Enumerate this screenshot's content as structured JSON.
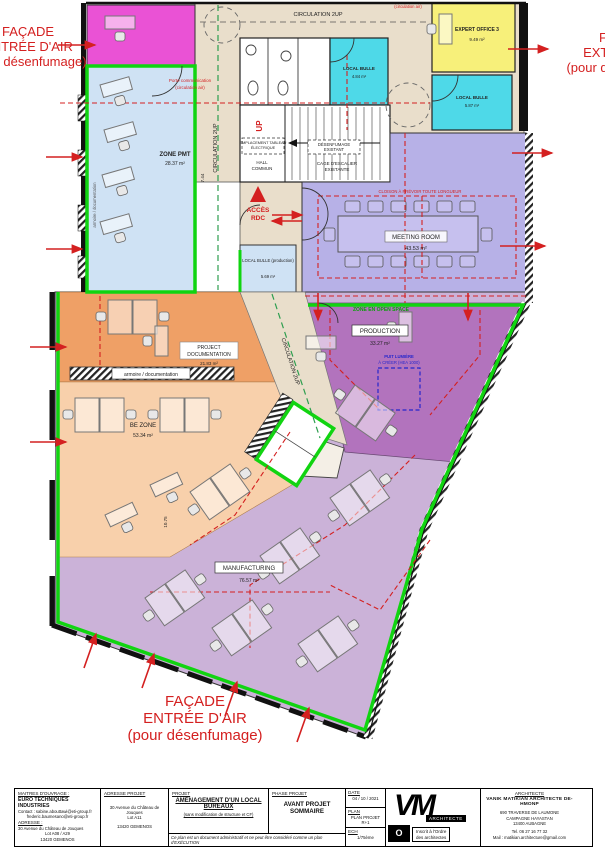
{
  "annotations": {
    "facade_tl_1": "FAÇADE",
    "facade_tl_2": "ENTRÉE D'AIR",
    "facade_tl_3": "(pour désenfumage)",
    "facade_tr_1": "FAÇADE",
    "facade_tr_2": "EXTRACTION",
    "facade_tr_3": "(pour désenfumage)",
    "facade_b_1": "FAÇADE",
    "facade_b_2": "ENTRÉE D'AIR",
    "facade_b_3": "(pour désenfumage)",
    "circulation_air": "(circulation air)",
    "porte_comm_1": "Porte communication",
    "porte_comm_2": "(circulation air)",
    "cloison": "CLOISON À PRÉVOIR TOUTE LONGUEUR",
    "zone_open_space": "ZONE EN OPEN SPACE",
    "puit_1": "PUIT LUMIÈRE",
    "puit_2": "À CRÉER (HEA 1000)",
    "acces_rdc_1": "ACCÈS",
    "acces_rdc_2": "RDC",
    "up": "UP"
  },
  "rooms": {
    "zone_pmt": {
      "name": "ZONE PMT",
      "area": "28.37 m²"
    },
    "expert_office": {
      "name": "EXPERT OFFICE 3",
      "area": "9.49 m²"
    },
    "local_bulle_1": {
      "name": "LOCAL BULLE",
      "area": "4.84 m²"
    },
    "local_bulle_2": {
      "name": "LOCAL BULLE",
      "area": "5.87 m²"
    },
    "local_bulle_prod": {
      "name": "LOCAL BULLE (production)",
      "area": "5.69 m²"
    },
    "meeting": {
      "name": "MEETING ROOM",
      "area": "43.53 m²"
    },
    "project_doc": {
      "name": "PROJECT",
      "name2": "DOCUMENTATION",
      "area": "21.83 m²"
    },
    "be_zone": {
      "name": "BE ZONE",
      "area": "53.34 m²"
    },
    "production": {
      "name": "PRODUCTION",
      "area": "33.27 m²"
    },
    "manufacturing": {
      "name": "MANUFACTURING",
      "area": "76.57 m²"
    },
    "hall_1": "HALL",
    "hall_2": "COMMUN",
    "cage_1": "CAGE D'ESCALIER",
    "cage_2": "EXISTANTE",
    "desenf_1": "DÉSENFUMAGE",
    "desenf_2": "EXISTANT",
    "tableau_1": "EMPLACEMENT TABLEAU",
    "tableau_2": "ÉLECTRIQUE"
  },
  "labels": {
    "circ_top": "CIRCULATION 2UP",
    "circ_vert": "CIRCULATION 2UP",
    "circ_diag": "CIRCULATION 2UP",
    "armoire_doc": "armoire / documentation",
    "armoire_doc_vert": "armoire / documentation",
    "dim_744": "7.44",
    "dim_1075": "10.75"
  },
  "titleblock": {
    "c1_h": "MAITRES D'OUVRAGE :",
    "c1_name": "EURO TECHNIQUES INDUSTRIES",
    "c1_l1": "Contact : sabine.abouttawi@eti-group.fr",
    "c1_l2": "frederic.baumesano@eti-group.fr",
    "c1_h2": "ADRESSE :",
    "c1_l3": "30 Avenue du Château de Jouques",
    "c1_l4": "Lot A08 / A29",
    "c1_l5": "13420 GEMENOS",
    "c2_h": "ADRESSE  PROJET",
    "c2_l1": "30 Avenue du Château de Jouques",
    "c2_l2": "Lot A11",
    "c2_l3": "13420 GEMENOS",
    "c3_h": "PROJET",
    "c3_t1": "AMÉNAGEMENT D'UN LOCAL",
    "c3_t2": "BUREAUX",
    "c3_sub": "(sans modification de structure et CF)",
    "c3_foot": "Ce plan est un document administratif et ne peut être considéré comme un plan d'EXÉCUTION",
    "c4_h": "PHASE PROJET",
    "c4_t1": "AVANT PROJET",
    "c4_t2": "SOMMAIRE",
    "date_h": "DATE",
    "date_v": "04 / 10 / 2021",
    "plan_h": "PLAN",
    "plan_v": "PLAN PROJET R+1",
    "ech_h": "ECH",
    "ech_v": "1/75ème",
    "logo_vm": "VM",
    "logo_archi": "ARCHITECTE",
    "logo_o": "O",
    "logo_ordre_1": "Inscrit à l'Ordre",
    "logo_ordre_2": "des architectes",
    "c7_h": "ARCHITECTE",
    "c7_name": "VANIK MATIKIAN ARCHITECTE DE-HMONP",
    "c7_a1": "690 TRAVERSE DE LAUMONE",
    "c7_a2": "CAMPAGNE HAYASTAN",
    "c7_a3": "13400 AUBAGNE",
    "c7_tel": "Tel. 06 27 16 77 32",
    "c7_mail": "Mail : matikian.architecture@gmail.com"
  }
}
